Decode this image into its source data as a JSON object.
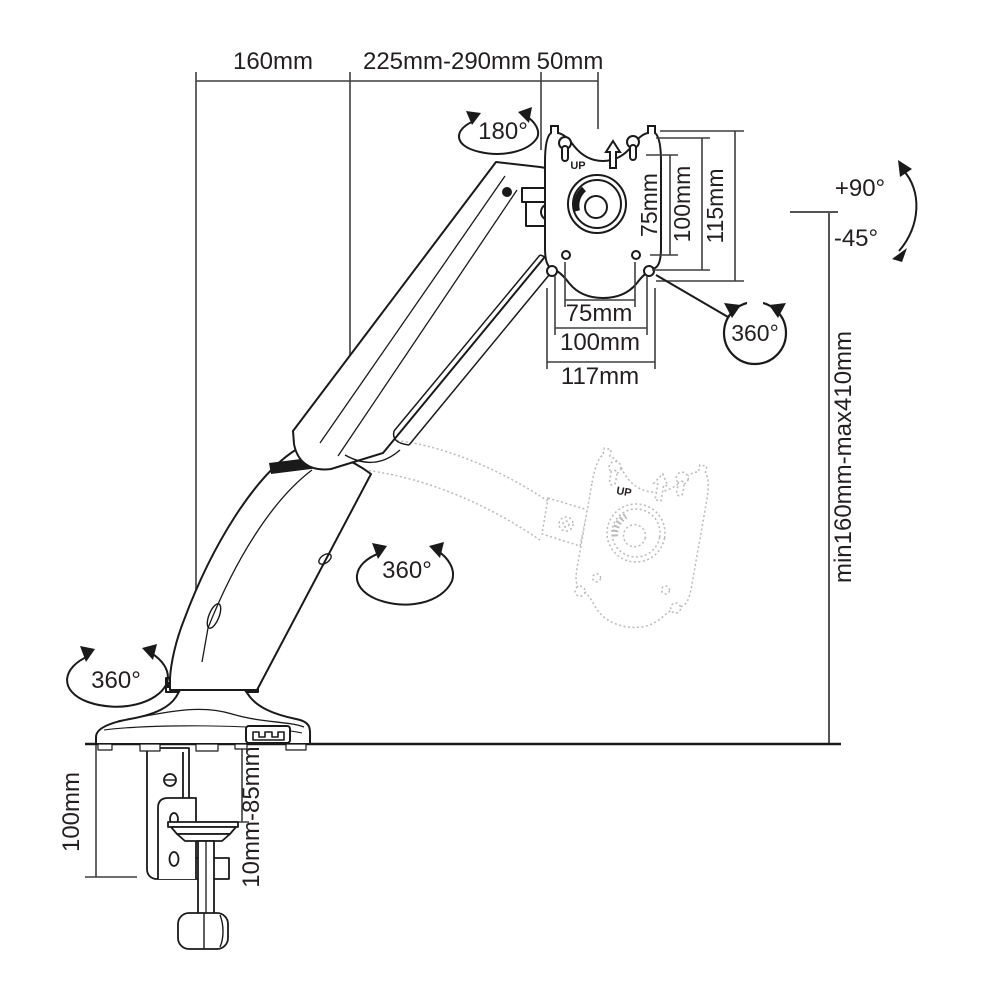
{
  "meta": {
    "description": "Technical dimension diagram of a gas-spring desk-mounted monitor arm with C-clamp base"
  },
  "labels": {
    "top": {
      "left": "160mm",
      "middle": "225mm-290mm",
      "right": "50mm"
    },
    "vesa_vertical": {
      "inner": "75mm",
      "middle": "100mm",
      "outer": "115mm"
    },
    "vesa_horizontal": {
      "inner": "75mm",
      "middle": "100mm",
      "outer": "117mm"
    },
    "rotation": {
      "head_swivel": "180°",
      "plate": "360°",
      "arm": "360°",
      "base": "360°"
    },
    "tilt": {
      "up": "+90°",
      "down": "-45°"
    },
    "height_range": "min160mm-max410mm",
    "clamp": {
      "height": "100mm",
      "desk_thickness": "10mm-85mm"
    },
    "plate": {
      "up": "UP"
    }
  },
  "colors": {
    "line": "#1a1a1a",
    "dimension": "#3f3f3f",
    "ghost": "#b9b9b9",
    "background": "#ffffff"
  }
}
